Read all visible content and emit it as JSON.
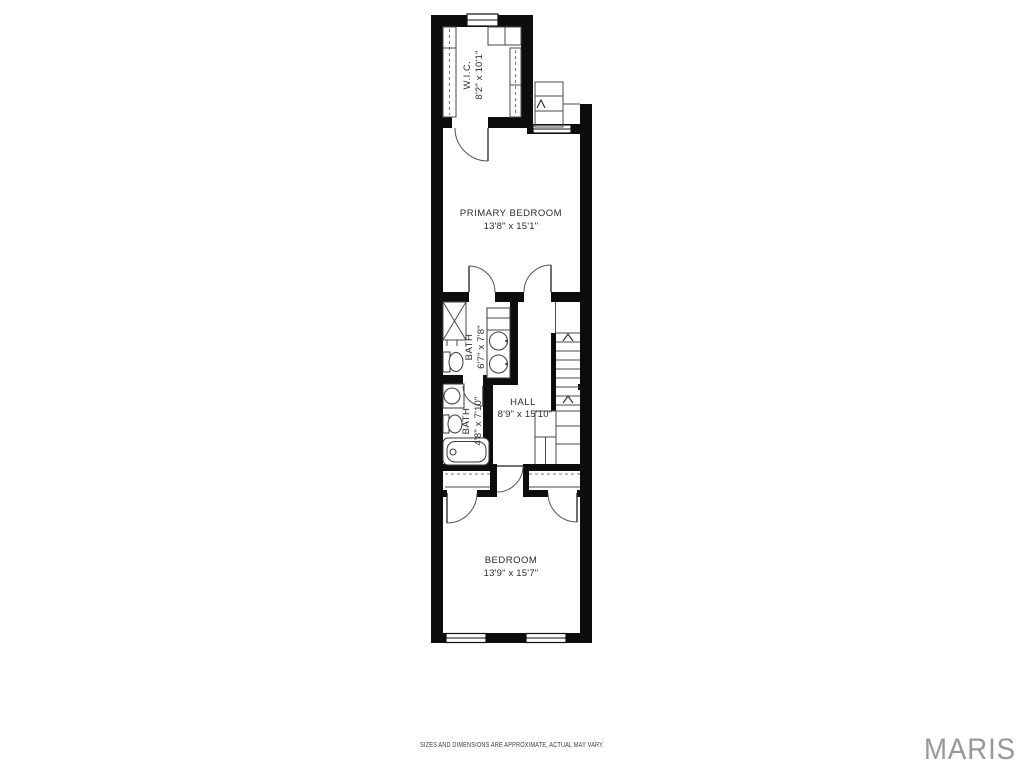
{
  "floor_plan": {
    "rooms": {
      "wic": {
        "name": "W.I.C.",
        "dims": "8'2\" x 10'1\""
      },
      "primary_bedroom": {
        "name": "PRIMARY BEDROOM",
        "dims": "13'8\" x 15'1\""
      },
      "bath1": {
        "name": "BATH",
        "dims": "6'7\" x 7'8\""
      },
      "bath2": {
        "name": "BATH",
        "dims": "4'8\" x 7'10\""
      },
      "hall": {
        "name": "HALL",
        "dims": "8'9\" x 15'10\""
      },
      "bedroom": {
        "name": "BEDROOM",
        "dims": "13'9\" x 15'7\""
      }
    },
    "wall_color": "#0d0d0d",
    "line_color": "#4a4a4a",
    "text_color": "#2b2b2b"
  },
  "footer": {
    "disclaimer": "SIZES AND DIMENSIONS ARE APPROXIMATE, ACTUAL MAY VARY.",
    "brand": "MARIS",
    "brand_color": "#97989a"
  }
}
